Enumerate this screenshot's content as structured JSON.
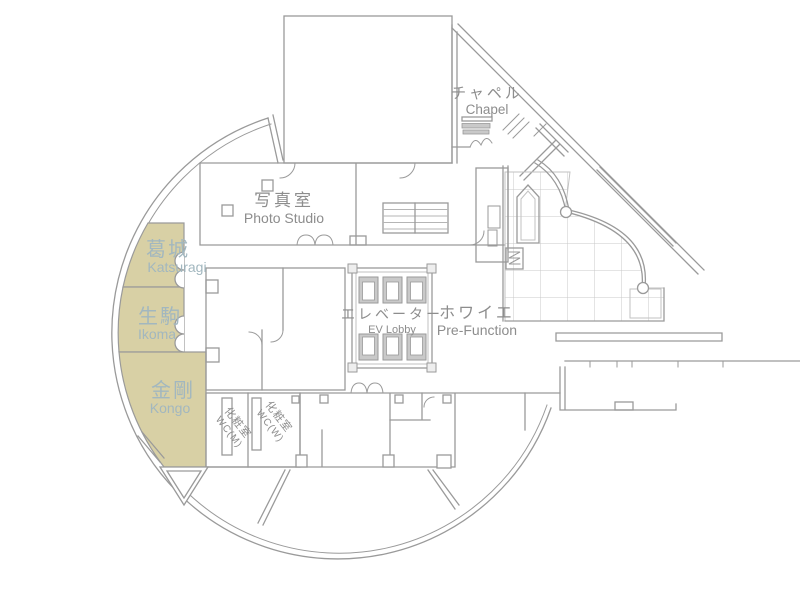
{
  "plan": {
    "type": "hotel-banquet-floor-plan",
    "highlighted_rooms": [
      "葛城 Katsuragi",
      "生駒 Ikoma",
      "金剛 Kongo"
    ]
  },
  "rooms": {
    "chapel": {
      "jp": "チャペル",
      "en": "Chapel"
    },
    "photo_studio": {
      "jp": "写真室",
      "en": "Photo Studio"
    },
    "katsuragi": {
      "jp": "葛城",
      "en": "Katsuragi"
    },
    "ikoma": {
      "jp": "生駒",
      "en": "Ikoma"
    },
    "kongo": {
      "jp": "金剛",
      "en": "Kongo"
    },
    "ev_lobby": {
      "jp": "エレベーター",
      "en": "EV Lobby"
    },
    "pre_function": {
      "jp": "ホワイエ",
      "en": "Pre-Function"
    },
    "wc_m": {
      "jp": "化粧室",
      "en": "WC(M)"
    },
    "wc_w": {
      "jp": "化粧室",
      "en": "WC(W)"
    }
  },
  "colors": {
    "highlight_fill": "#d8d0a5",
    "highlight_text": "#a2b7bf",
    "label_text": "#8d8d8d",
    "wall": "#9a9a9a",
    "background": "#ffffff"
  }
}
